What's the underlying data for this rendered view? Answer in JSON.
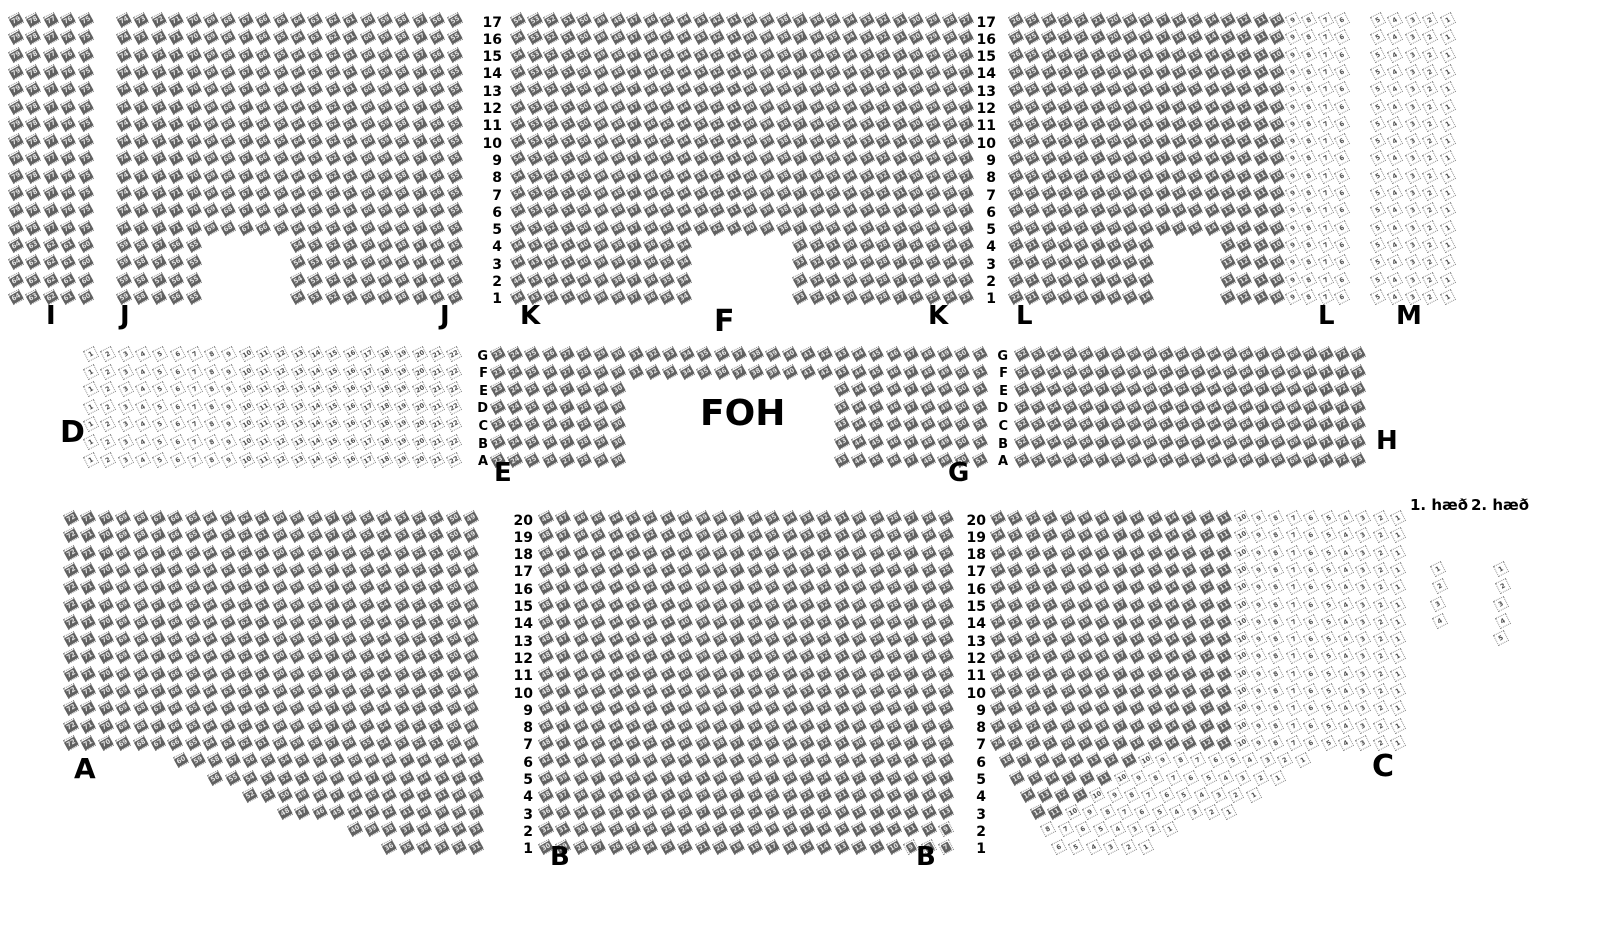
{
  "title": "seating-chart",
  "colors": {
    "background": "#ffffff",
    "seat_border": "#8f8f8f",
    "seat_taken_fill": "#616161",
    "seat_taken_text": "#e6e6e6",
    "seat_free_text": "#4d4d4d",
    "label_color": "#000000"
  },
  "foh": {
    "label": "FOH",
    "x": 700,
    "y": 396,
    "size": 36
  },
  "floor_labels": [
    {
      "text": "1. hæð",
      "x": 1410,
      "y": 498,
      "size": 15
    },
    {
      "text": "2. hæð",
      "x": 1471,
      "y": 498,
      "size": 15
    }
  ],
  "section_labels": [
    {
      "text": "I",
      "x": 46,
      "y": 303,
      "size": 26
    },
    {
      "text": "J",
      "x": 120,
      "y": 303,
      "size": 26
    },
    {
      "text": "J",
      "x": 440,
      "y": 303,
      "size": 26
    },
    {
      "text": "K",
      "x": 520,
      "y": 303,
      "size": 26
    },
    {
      "text": "F",
      "x": 714,
      "y": 307,
      "size": 30
    },
    {
      "text": "K",
      "x": 928,
      "y": 303,
      "size": 26
    },
    {
      "text": "L",
      "x": 1016,
      "y": 303,
      "size": 26
    },
    {
      "text": "L",
      "x": 1318,
      "y": 303,
      "size": 26
    },
    {
      "text": "M",
      "x": 1396,
      "y": 303,
      "size": 26
    },
    {
      "text": "D",
      "x": 60,
      "y": 418,
      "size": 30
    },
    {
      "text": "E",
      "x": 494,
      "y": 460,
      "size": 26
    },
    {
      "text": "G",
      "x": 948,
      "y": 460,
      "size": 26
    },
    {
      "text": "H",
      "x": 1376,
      "y": 428,
      "size": 26
    },
    {
      "text": "A",
      "x": 74,
      "y": 755,
      "size": 28
    },
    {
      "text": "B",
      "x": 550,
      "y": 844,
      "size": 26
    },
    {
      "text": "B",
      "x": 916,
      "y": 844,
      "size": 26
    },
    {
      "text": "C",
      "x": 1372,
      "y": 752,
      "size": 30
    }
  ],
  "row_labels": {
    "top": [
      "17",
      "16",
      "15",
      "14",
      "13",
      "12",
      "11",
      "10",
      "9",
      "8",
      "7",
      "6",
      "5",
      "4",
      "3",
      "2",
      "1"
    ],
    "middle": [
      "G",
      "F",
      "E",
      "D",
      "C",
      "B",
      "A"
    ],
    "bottom": [
      "20",
      "19",
      "18",
      "17",
      "16",
      "15",
      "14",
      "13",
      "12",
      "11",
      "10",
      "9",
      "8",
      "7",
      "6",
      "5",
      "4",
      "3",
      "2",
      "1"
    ]
  },
  "row_number_columns": [
    {
      "band": "top",
      "right_x": 502,
      "size": 14
    },
    {
      "band": "top",
      "right_x": 996,
      "size": 14
    },
    {
      "band": "middle",
      "right_x": 488,
      "size": 13
    },
    {
      "band": "middle",
      "right_x": 1008,
      "size": 13
    },
    {
      "band": "bottom",
      "right_x": 533,
      "size": 14
    },
    {
      "band": "bottom",
      "right_x": 986,
      "size": 14
    }
  ],
  "bands": [
    {
      "name": "top",
      "y0": 14,
      "row_h": 17.3,
      "rows": 17,
      "numbering": "right_to_left",
      "sections": [
        {
          "name": "I",
          "x0": 10,
          "col_w": 17.4,
          "cols": 5,
          "status": "taken"
        },
        {
          "name": "J",
          "x0": 118,
          "col_w": 17.4,
          "cols": 20,
          "status": "taken",
          "notch": {
            "col_from": 6,
            "col_to": 10,
            "row_from": 1,
            "row_to": 4
          }
        },
        {
          "name": "K",
          "x0": 512,
          "col_w": 16.6,
          "cols": 28,
          "status": "taken",
          "notch": {
            "col_from": 12,
            "col_to": 17,
            "row_from": 1,
            "row_to": 4
          }
        },
        {
          "name": "L",
          "x0": 1010,
          "col_w": 16.3,
          "cols": 21,
          "status": "taken",
          "light_col_from": 18,
          "notch": {
            "col_from": 10,
            "col_to": 13,
            "row_from": 1,
            "row_to": 4
          }
        },
        {
          "name": "M",
          "x0": 1372,
          "col_w": 17.4,
          "cols": 5,
          "status": "free"
        }
      ]
    },
    {
      "name": "middle",
      "y0": 348,
      "row_h": 17.6,
      "rows": 7,
      "numbering": "left_to_right",
      "sections": [
        {
          "name": "D",
          "x0": 85,
          "col_w": 17.3,
          "cols": 22,
          "status": "free",
          "start_number": 1
        },
        {
          "name": "EG",
          "x0": 492,
          "col_w": 17.2,
          "cols": 29,
          "status": "taken",
          "start_number": 23,
          "foh_gap": {
            "col_from": 9,
            "col_to": 20,
            "row_index_from": 2,
            "row_index_to": 6
          }
        },
        {
          "name": "H",
          "x0": 1016,
          "col_w": 16.0,
          "cols": 22,
          "status": "taken",
          "start_number": 52
        }
      ]
    },
    {
      "name": "bottom",
      "y0": 512,
      "row_h": 17.3,
      "rows": 20,
      "numbering": "right_to_left",
      "sections": [
        {
          "name": "A",
          "x0": 65,
          "col_w": 17.4,
          "cols": 24,
          "status": "taken",
          "short_rows": {
            "6": {
              "count": 18,
              "offset": 6.3
            },
            "5": {
              "count": 16,
              "offset": 8.3
            },
            "4": {
              "count": 14,
              "offset": 10.3
            },
            "3": {
              "count": 12,
              "offset": 12.3
            },
            "2": {
              "count": 8,
              "offset": 16.3
            },
            "1": {
              "count": 6,
              "offset": 18.3
            }
          }
        },
        {
          "name": "B",
          "x0": 540,
          "col_w": 17.4,
          "cols": 24,
          "status": "taken"
        },
        {
          "name": "C",
          "x0": 992,
          "col_w": 17.4,
          "cols": 24,
          "status": "taken",
          "free_max_number": 10,
          "short_rows": {
            "6": {
              "count": 18,
              "offset": 0.5
            },
            "5": {
              "count": 16,
              "offset": 1.1
            },
            "4": {
              "count": 14,
              "offset": 1.7
            },
            "3": {
              "count": 12,
              "offset": 2.3
            },
            "2": {
              "count": 8,
              "offset": 2.9
            },
            "1": {
              "count": 6,
              "offset": 3.5
            }
          }
        }
      ]
    }
  ],
  "mini_sections": [
    {
      "name": "floor1-seats",
      "x": 1432,
      "y0": 563,
      "row_h": 17.3,
      "count": 4,
      "status": "free"
    },
    {
      "name": "floor2-seats",
      "x": 1495,
      "y0": 563,
      "row_h": 17.3,
      "count": 5,
      "status": "free"
    }
  ]
}
